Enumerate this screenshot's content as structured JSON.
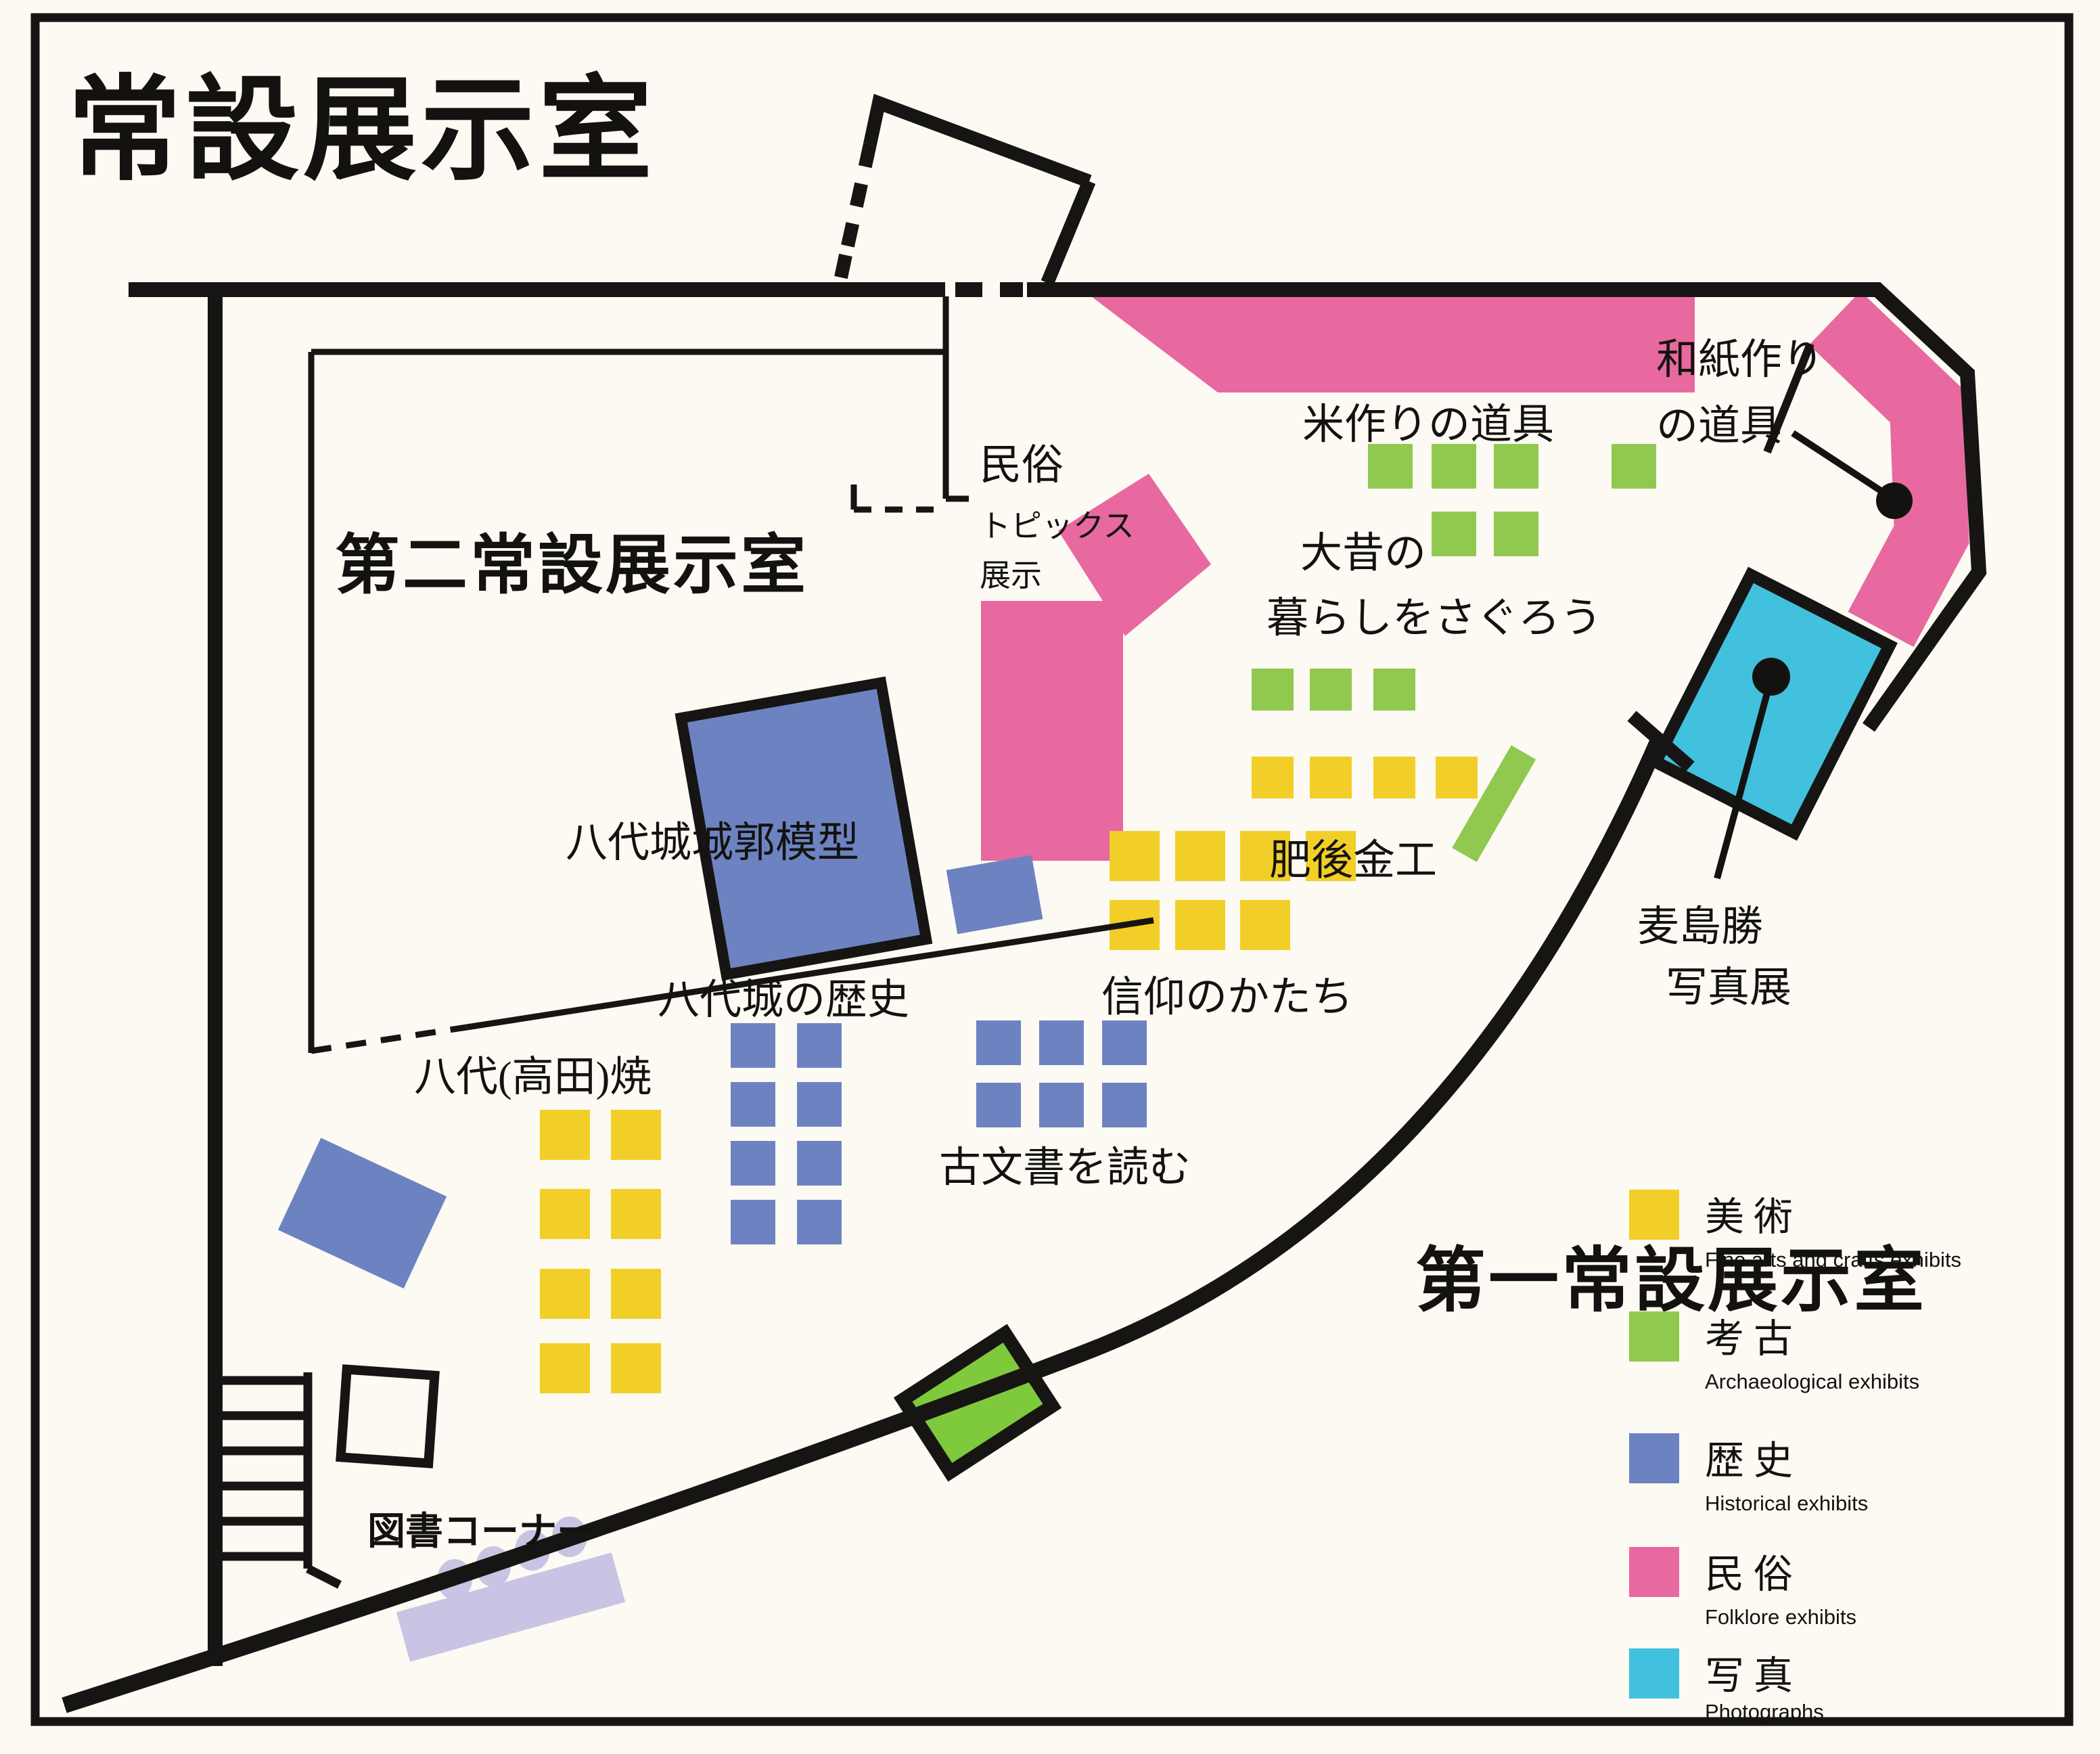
{
  "title": "常設展示室",
  "rooms": {
    "room1": "第一常設展示室",
    "room2": "第二常設展示室"
  },
  "labels": {
    "rice_tools": "米作りの道具",
    "washi_line1": "和紙作り",
    "washi_line2": "の道具",
    "minzoku_line1": "民俗",
    "minzoku_line2": "トピックス",
    "minzoku_line3": "展示",
    "omukashi_line1": "大昔の",
    "omukashi_line2": "暮らしをさぐろう",
    "higo_kinko": "肥後金工",
    "castle_model": "八代城城郭模型",
    "shinko": "信仰のかたち",
    "castle_history": "八代城の歴史",
    "yatsushiro_yaki": "八代(高田)焼",
    "komonjo": "古文書を読む",
    "mugishima_line1": "麦島勝",
    "mugishima_line2": "写真展",
    "library": "図書コーナー"
  },
  "legend": [
    {
      "key": "fine-arts",
      "jp": "美術",
      "en": "Fine arts and crafts exhibits",
      "color": "#f2cf28"
    },
    {
      "key": "archaeology",
      "jp": "考古",
      "en": "Archaeological exhibits",
      "color": "#90c850"
    },
    {
      "key": "history",
      "jp": "歴史",
      "en": "Historical exhibits",
      "color": "#6d83c1"
    },
    {
      "key": "folklore",
      "jp": "民俗",
      "en": "Folklore exhibits",
      "color": "#e7699f"
    },
    {
      "key": "photographs",
      "jp": "写真",
      "en": "Photographs",
      "color": "#41c1de"
    }
  ],
  "colors": {
    "wall": "#171513",
    "paper": "#fcfaf2",
    "door_green": "#7fc93d",
    "lavender": "#c9c4e3"
  },
  "cases": [
    {
      "name": "omukashi-archaeology-cases",
      "color": "#90c850",
      "size": 66,
      "squares": [
        [
          2022,
          656
        ],
        [
          2116,
          656
        ],
        [
          2208,
          656
        ],
        [
          2382,
          656
        ],
        [
          2116,
          756
        ],
        [
          2208,
          756
        ]
      ]
    },
    {
      "name": "higo-archaeology-cases",
      "color": "#90c850",
      "size": 62,
      "squares": [
        [
          1850,
          988
        ],
        [
          1936,
          988
        ],
        [
          2030,
          988
        ]
      ]
    },
    {
      "name": "higo-fine-arts-cases",
      "color": "#f2cf28",
      "size": 62,
      "squares": [
        [
          1850,
          1118
        ],
        [
          1936,
          1118
        ],
        [
          2030,
          1118
        ],
        [
          2122,
          1118
        ]
      ]
    },
    {
      "name": "shinko-fine-arts-cases",
      "color": "#f2cf28",
      "size": 74,
      "squares": [
        [
          1640,
          1228
        ],
        [
          1737,
          1228
        ],
        [
          1833,
          1228
        ],
        [
          1930,
          1228
        ],
        [
          1640,
          1330
        ],
        [
          1737,
          1330
        ],
        [
          1833,
          1330
        ]
      ]
    },
    {
      "name": "castle-history-cases",
      "color": "#6d83c1",
      "size": 66,
      "squares": [
        [
          1080,
          1512
        ],
        [
          1178,
          1512
        ],
        [
          1080,
          1599
        ],
        [
          1178,
          1599
        ],
        [
          1080,
          1686
        ],
        [
          1178,
          1686
        ],
        [
          1080,
          1773
        ],
        [
          1178,
          1773
        ]
      ]
    },
    {
      "name": "komonjo-history-cases",
      "color": "#6d83c1",
      "size": 66,
      "squares": [
        [
          1443,
          1508
        ],
        [
          1536,
          1508
        ],
        [
          1629,
          1508
        ],
        [
          1443,
          1600
        ],
        [
          1536,
          1600
        ],
        [
          1629,
          1600
        ]
      ]
    },
    {
      "name": "yaki-fine-arts-cases",
      "color": "#f2cf28",
      "size": 74,
      "squares": [
        [
          798,
          1640
        ],
        [
          903,
          1640
        ],
        [
          798,
          1757
        ],
        [
          903,
          1757
        ],
        [
          798,
          1875
        ],
        [
          903,
          1875
        ],
        [
          798,
          1985
        ],
        [
          903,
          1985
        ]
      ]
    }
  ],
  "library_corner": {
    "stools": [
      [
        672,
        2334
      ],
      [
        729,
        2315
      ],
      [
        787,
        2291
      ],
      [
        842,
        2271
      ]
    ]
  }
}
